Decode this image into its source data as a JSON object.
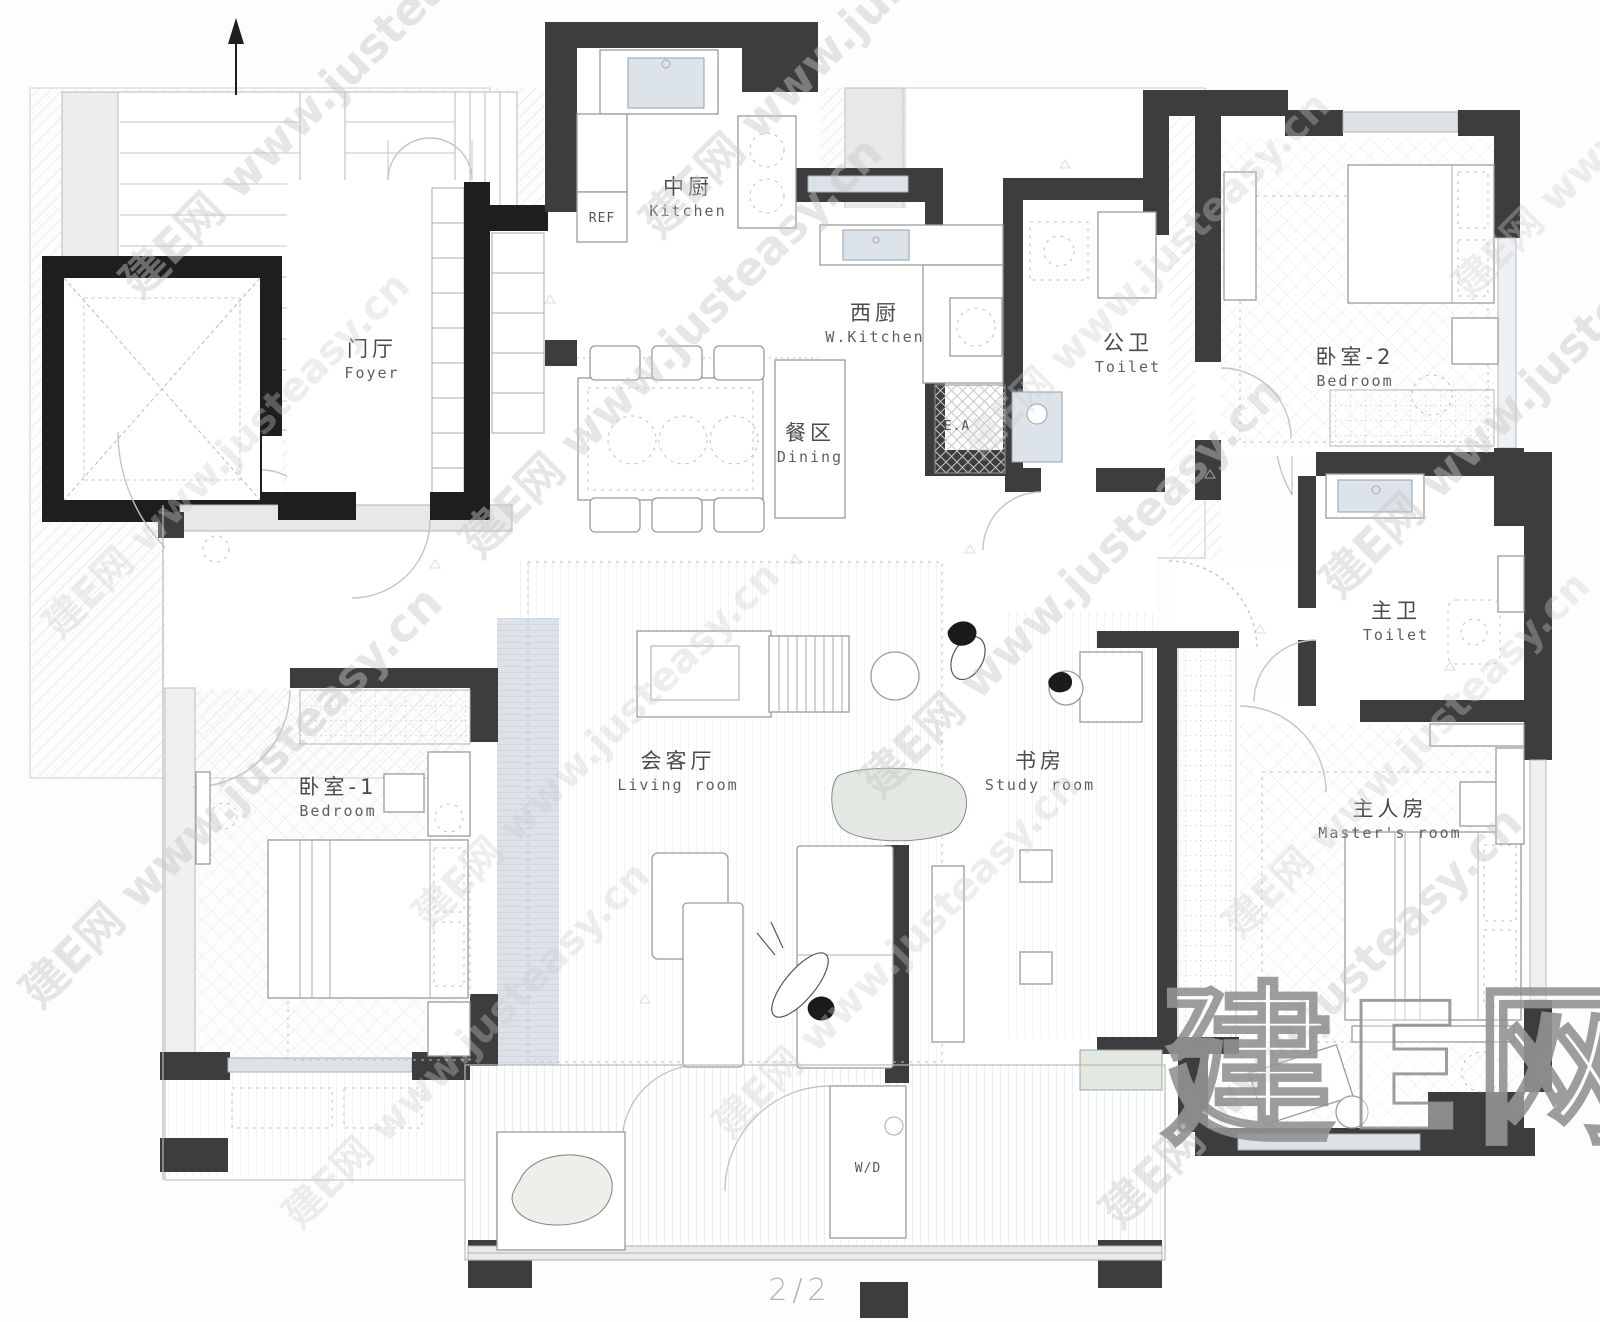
{
  "plan": {
    "page_label": "2/2",
    "rooms": {
      "kitchen": {
        "cn": "中厨",
        "en": "Kitchen"
      },
      "west_kitchen": {
        "cn": "西厨",
        "en": "W.Kitchen"
      },
      "dining": {
        "cn": "餐区",
        "en": "Dining"
      },
      "foyer": {
        "cn": "门厅",
        "en": "Foyer"
      },
      "public_toilet": {
        "cn": "公卫",
        "en": "Toilet"
      },
      "bedroom_2": {
        "cn": "卧室-2",
        "en": "Bedroom"
      },
      "master_toilet": {
        "cn": "主卫",
        "en": "Toilet"
      },
      "living_room": {
        "cn": "会客厅",
        "en": "Living room"
      },
      "study": {
        "cn": "书房",
        "en": "Study room"
      },
      "bedroom_1": {
        "cn": "卧室-1",
        "en": "Bedroom"
      },
      "master_room": {
        "cn": "主人房",
        "en": "Master's room"
      }
    },
    "annotations": {
      "fridge": "REF",
      "exhaust_shaft": "E.A",
      "washer_dryer": "W/D"
    }
  },
  "watermark": {
    "brand": "建E网",
    "url": "www.justeasy.cn",
    "line": "建E网 www.justeasy.cn"
  },
  "colors": {
    "wall_dark": "#3d3d3f",
    "wall_black": "#1e1e1e",
    "window": "#dde2e7",
    "fixture": "#dce4ea",
    "watermark_gray": "#c8c8c8"
  }
}
